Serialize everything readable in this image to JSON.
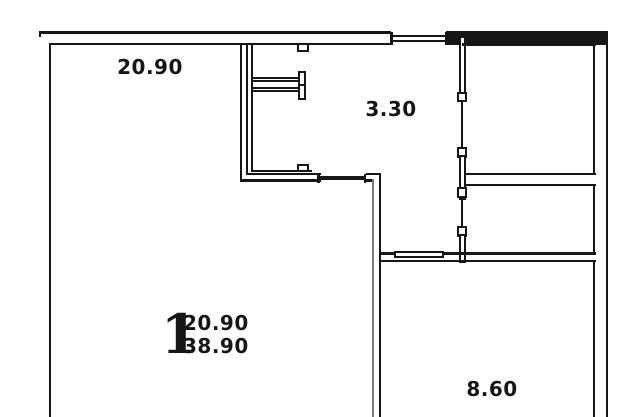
{
  "drawing": {
    "type": "apartment-floor-plan",
    "rooms": [
      {
        "name": "living-room",
        "area": "20.90"
      },
      {
        "name": "hallway",
        "area": "3.30"
      },
      {
        "name": "kitchen",
        "area": "8.60"
      }
    ],
    "stamp": {
      "room_count": "1",
      "living_area": "20.90",
      "total_area": "38.90"
    }
  },
  "colors": {
    "background": "#ffffff",
    "line": "#161616",
    "line_light": "#7a7a7a"
  }
}
